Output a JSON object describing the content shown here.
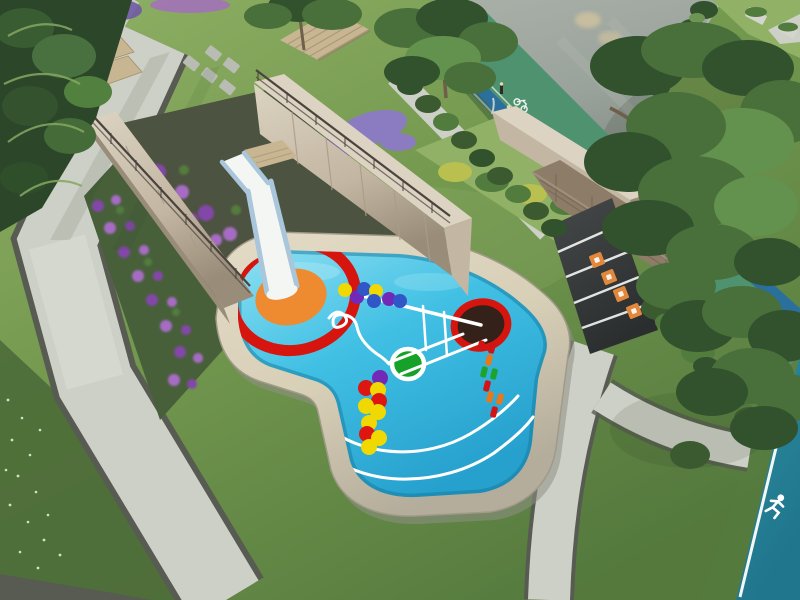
{
  "image_type": "3d-architectural-rendering-aerial",
  "subject": "Landscaped children's splash playground with slide, flower trench, jogging track and gardens",
  "icons": [
    "runner-icon",
    "bicycle-icon"
  ],
  "palette": {
    "lawn": "#74994f",
    "lawn_light": "#90b166",
    "lawn_dark": "#557a3e",
    "lawn_deep": "#4c6b38",
    "grass_speckle": "#eef3e0",
    "path": "#cdd0c6",
    "path_light": "#e0e3da",
    "path_edge": "#585b51",
    "road": "#99a29b",
    "road_light": "#a9b0a8",
    "road_dark": "#79817a",
    "road_glow": "#e6cf9d",
    "curb": "#c4c9bf",
    "track_green": "#4f9270",
    "track_blue": "#2b6f9d",
    "track_teal": "#2b8ba1",
    "track_teal_dark": "#20768c",
    "lane_white": "#f4f7f4",
    "pool": "#41c0e4",
    "pool_light": "#8fe0f2",
    "pool_deep": "#26a0cd",
    "pool_edge": "#157a9e",
    "coping": "#d8cfb7",
    "coping_light": "#e3dbc6",
    "coping_dark": "#b4ad9b",
    "coping_shadow": "#8f9086",
    "wall_face": "#c3b6a2",
    "wall_cap": "#dcd3c2",
    "wall_dark": "#998c79",
    "wall_joint": "#a99d8a",
    "trench": "#4c5340",
    "slide_white": "#f4f6f4",
    "slide_rail": "#a9c6da",
    "deck_wood": "#c8b592",
    "deck_slat": "#ab9878",
    "stone_wall": "#8c7c68",
    "stone_line": "#6d5f4c",
    "ramp": "#46494a",
    "ramp_dark": "#2b2e2f",
    "marker_orange": "#e2883c",
    "hedge": "#3b5a30",
    "hedge_light": "#527b3e",
    "tree_dark": "#32512d",
    "tree_mid": "#49703b",
    "tree_light": "#63914e",
    "tree_lighter": "#86a862",
    "trunk": "#6f5f4a",
    "trunk_pale": "#b4a78f",
    "foliage_deep": "#2c462a",
    "flowerbed_base": "#47603a",
    "flower_purple": "#8347a8",
    "flower_purple2": "#a66cc4",
    "lavender": "#8b7cc2",
    "lavender_dark": "#6f5ba6",
    "shrub_yellow": "#b9c04f",
    "water_left": "#2a7d88",
    "water_left_dark": "#14525c",
    "wall_white": "#d9dad2",
    "ring_red": "#d6150e",
    "splash_orange": "#ee8a2f",
    "target_dark": "#33211a",
    "dot_yellow": "#f0d803",
    "dot_red": "#dd1612",
    "dot_purple": "#7229b8",
    "dot_blue": "#3056c8",
    "dot_green": "#16a228",
    "dash_red": "#d31414",
    "dash_orange": "#e5791b",
    "dash_green": "#1da32d",
    "mark_white": "#ffffff",
    "railing": "#4b443e",
    "bollard": "#2b2b26",
    "bollard_cap": "#e9daa6",
    "shadow": "#2c3a22"
  },
  "splash_pad": {
    "red_ring": {
      "cx": 294,
      "cy": 297,
      "rx": 62,
      "ry": 53,
      "rot": -14,
      "stroke": "ring_red",
      "sw": 11
    },
    "orange_center": {
      "cx": 291,
      "cy": 297,
      "rx": 36,
      "ry": 28,
      "rot": -14,
      "fill": "splash_orange"
    },
    "target_circle": {
      "cx": 481,
      "cy": 325,
      "rx": 27,
      "ry": 23,
      "rot": -12,
      "fill": "target_dark",
      "stroke": "ring_red",
      "sw": 7
    },
    "green_circle": {
      "cx": 408,
      "cy": 364,
      "rx": 16,
      "ry": 15,
      "rot": 0,
      "fill": "dot_green",
      "stroke": "mark_white",
      "sw": 4.5
    },
    "arc_dots": [
      {
        "x": 345,
        "y": 290,
        "r": 7,
        "c": "dot_yellow"
      },
      {
        "x": 357,
        "y": 297,
        "r": 7,
        "c": "dot_purple"
      },
      {
        "x": 364,
        "y": 289,
        "r": 7,
        "c": "dot_blue"
      },
      {
        "x": 376,
        "y": 291,
        "r": 7,
        "c": "dot_yellow"
      },
      {
        "x": 374,
        "y": 301,
        "r": 7,
        "c": "dot_blue"
      },
      {
        "x": 389,
        "y": 299,
        "r": 7,
        "c": "dot_purple"
      },
      {
        "x": 400,
        "y": 301,
        "r": 7,
        "c": "dot_blue"
      }
    ],
    "column_dots": [
      {
        "x": 380,
        "y": 378,
        "r": 8,
        "c": "dot_purple"
      },
      {
        "x": 366,
        "y": 388,
        "r": 8,
        "c": "dot_red"
      },
      {
        "x": 378,
        "y": 390,
        "r": 8,
        "c": "dot_yellow"
      },
      {
        "x": 379,
        "y": 401,
        "r": 8,
        "c": "dot_red"
      },
      {
        "x": 366,
        "y": 406,
        "r": 8,
        "c": "dot_yellow"
      },
      {
        "x": 378,
        "y": 412,
        "r": 8,
        "c": "dot_yellow"
      },
      {
        "x": 369,
        "y": 423,
        "r": 8,
        "c": "dot_yellow"
      },
      {
        "x": 367,
        "y": 434,
        "r": 8,
        "c": "dot_red"
      },
      {
        "x": 379,
        "y": 438,
        "r": 8,
        "c": "dot_yellow"
      },
      {
        "x": 369,
        "y": 447,
        "r": 8,
        "c": "dot_yellow"
      }
    ],
    "dash_trail": [
      {
        "x": 481,
        "y": 346,
        "c": "dash_red"
      },
      {
        "x": 492,
        "y": 348,
        "c": "dash_red"
      },
      {
        "x": 489,
        "y": 360,
        "c": "dash_orange"
      },
      {
        "x": 484,
        "y": 372,
        "c": "dash_green"
      },
      {
        "x": 494,
        "y": 374,
        "c": "dash_green"
      },
      {
        "x": 487,
        "y": 386,
        "c": "dash_red"
      },
      {
        "x": 490,
        "y": 397,
        "c": "dash_orange"
      },
      {
        "x": 500,
        "y": 399,
        "c": "dash_orange"
      },
      {
        "x": 494,
        "y": 412,
        "c": "dash_red"
      }
    ]
  },
  "ramp_markers": [
    {
      "x": 597,
      "y": 260
    },
    {
      "x": 609,
      "y": 277
    },
    {
      "x": 621,
      "y": 294
    },
    {
      "x": 634,
      "y": 311
    }
  ]
}
